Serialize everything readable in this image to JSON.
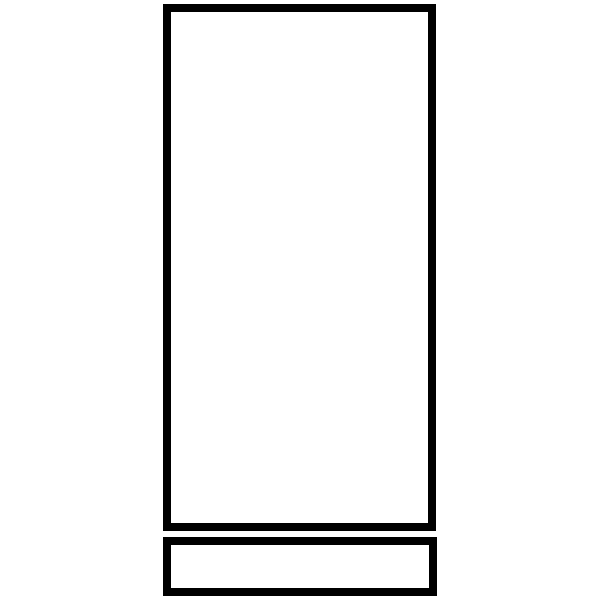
{
  "canvas": {
    "width": 600,
    "height": 600,
    "background_color": "#ffffff"
  },
  "drawing": {
    "description": "line drawing of a tall upright rectangle with a short wide rectangle base below it",
    "stroke_color": "#000000",
    "fill_color": "#ffffff",
    "shapes": {
      "tall_rectangle": {
        "x": 167,
        "y": 8,
        "width": 265,
        "height": 519,
        "stroke_width": 8
      },
      "base_rectangle": {
        "x": 167,
        "y": 541,
        "width": 266,
        "height": 51,
        "stroke_width": 8
      }
    }
  }
}
